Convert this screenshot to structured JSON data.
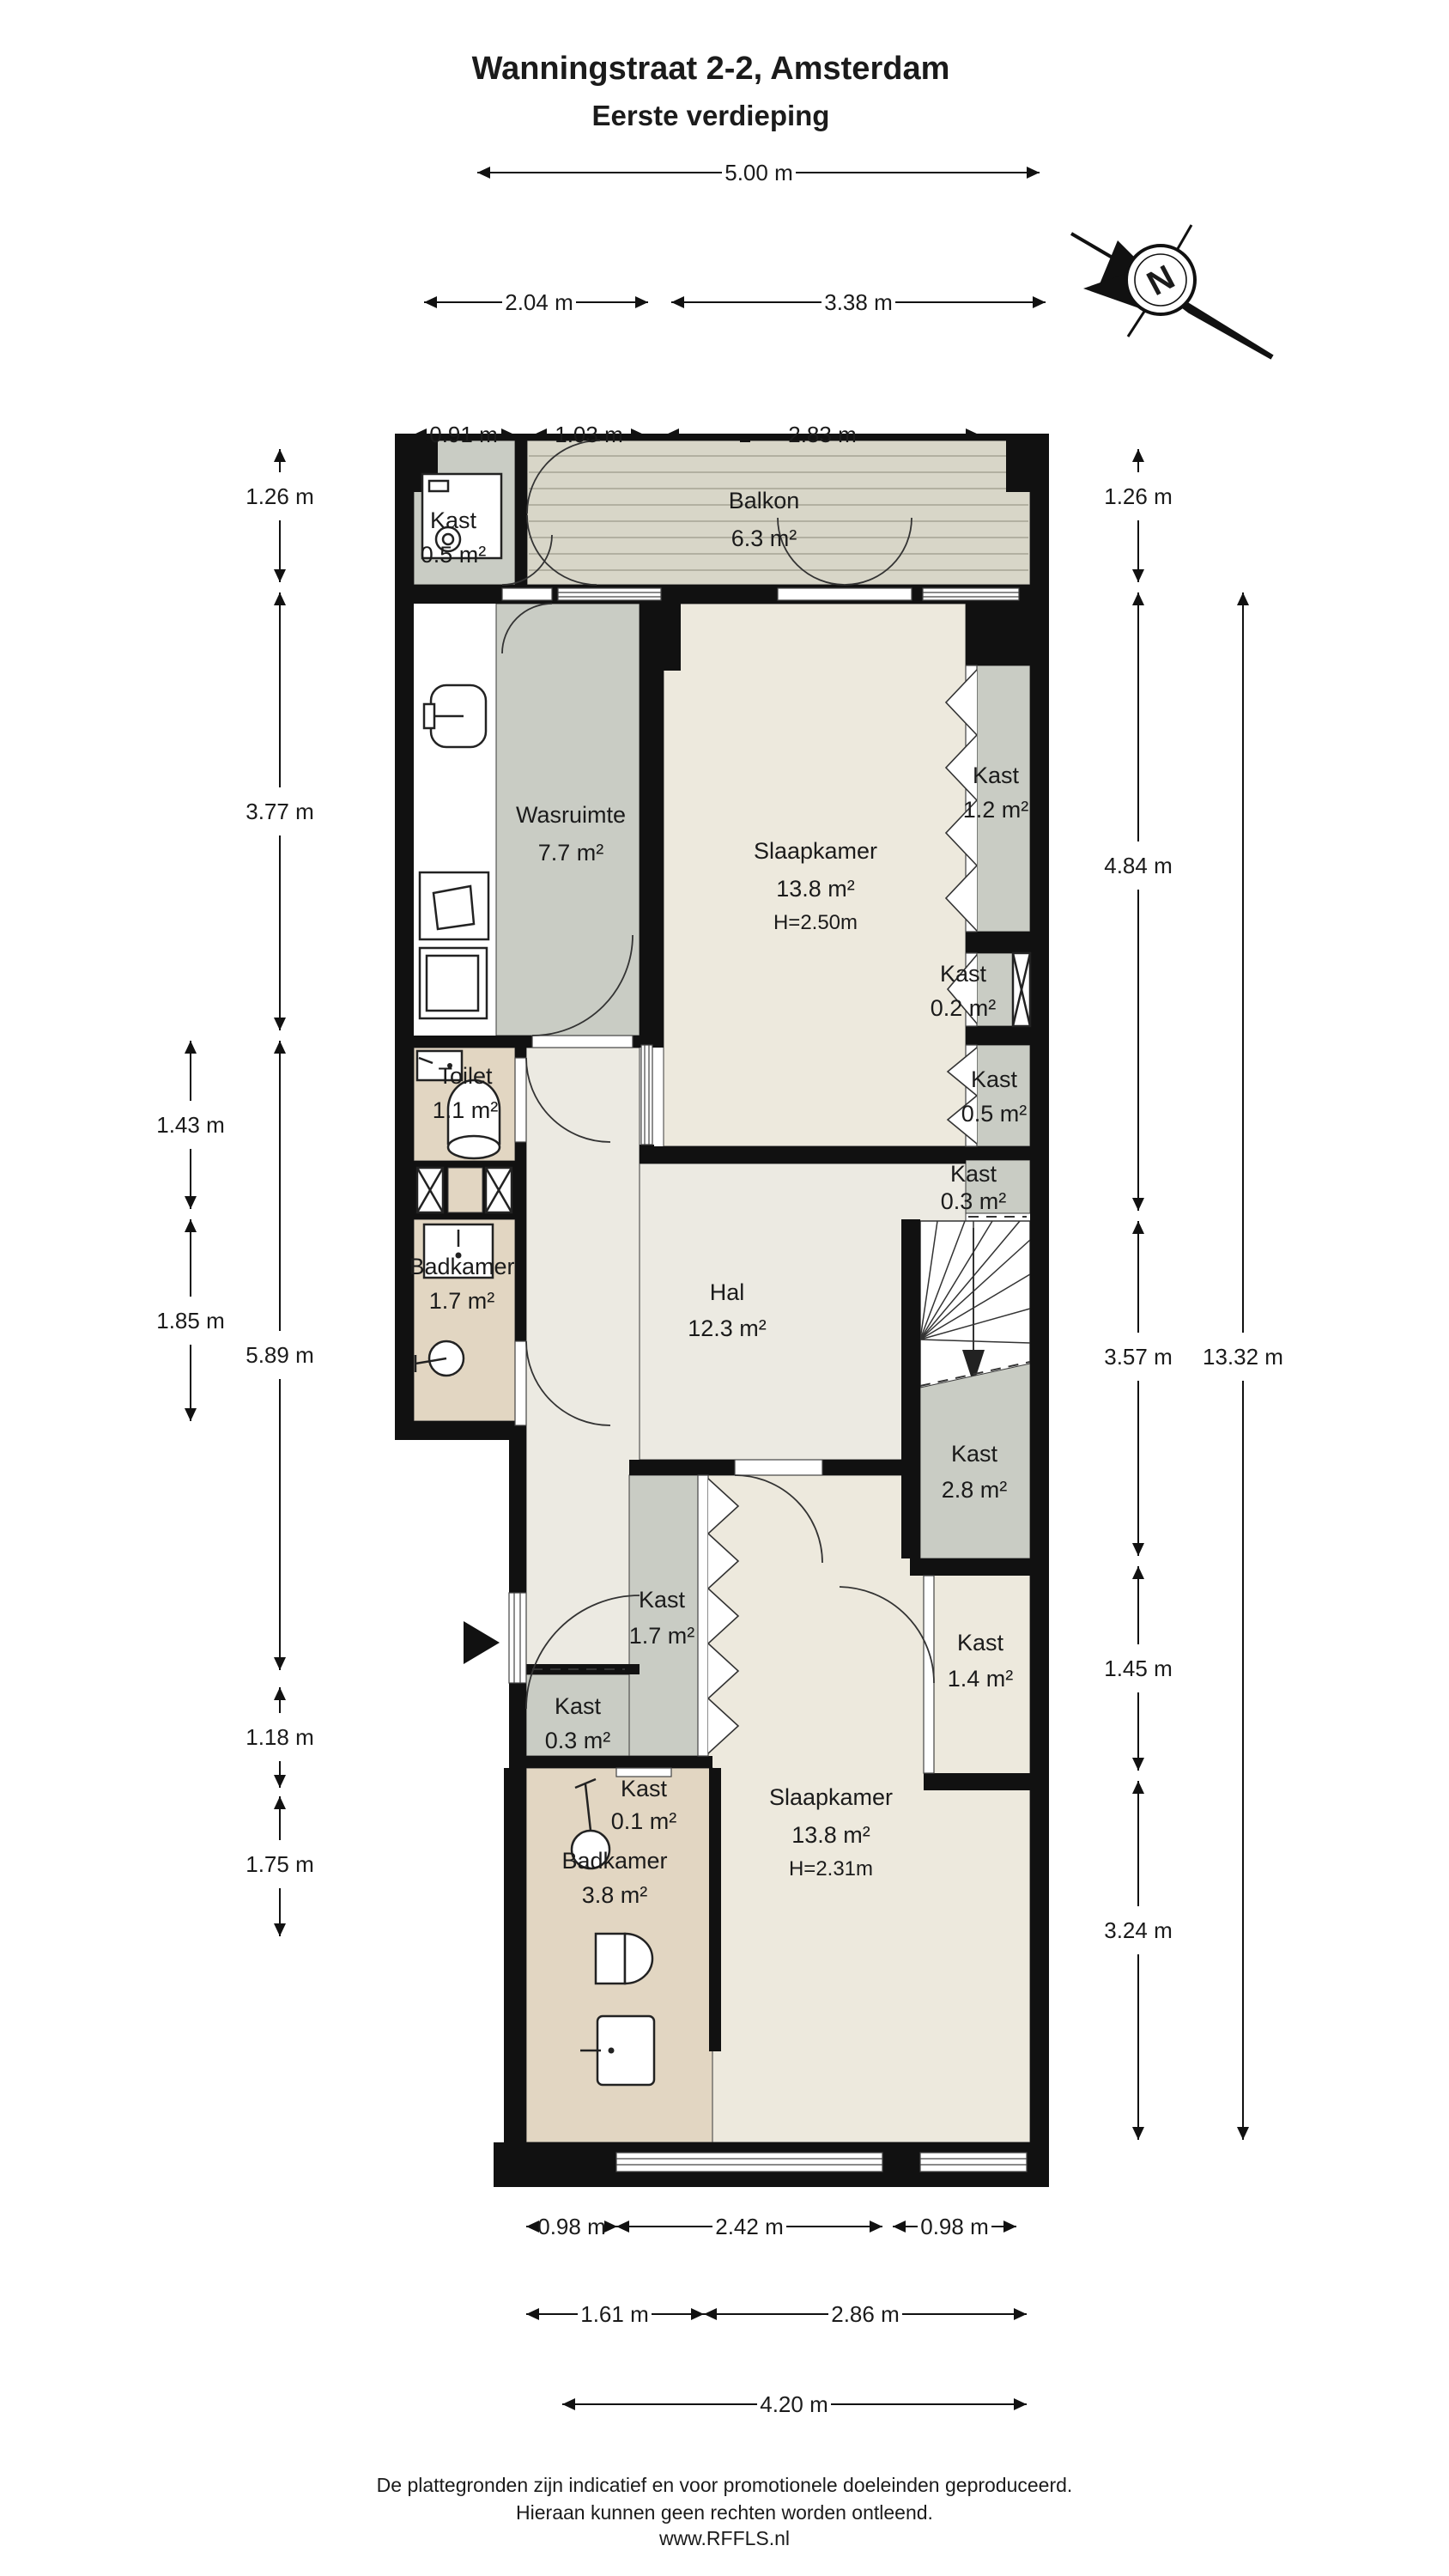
{
  "title": {
    "line1": "Wanningstraat 2-2, Amsterdam",
    "line2": "Eerste verdieping"
  },
  "compass": {
    "north_label": "N"
  },
  "rooms": {
    "kast_balkon": {
      "name": "Kast",
      "area": "0.5 m²"
    },
    "balkon": {
      "name": "Balkon",
      "area": "6.3 m²"
    },
    "wasruimte": {
      "name": "Wasruimte",
      "area": "7.7 m²"
    },
    "slaapkamer_boven": {
      "name": "Slaapkamer",
      "area": "13.8 m²",
      "hoogte": "H=2.50m"
    },
    "kast_1_2": {
      "name": "Kast",
      "area": "1.2 m²"
    },
    "kast_0_2": {
      "name": "Kast",
      "area": "0.2 m²"
    },
    "kast_0_5": {
      "name": "Kast",
      "area": "0.5 m²"
    },
    "kast_0_3_rechts": {
      "name": "Kast",
      "area": "0.3 m²"
    },
    "toilet": {
      "name": "Toilet",
      "area": "1.1 m²"
    },
    "badkamer_boven": {
      "name": "Badkamer",
      "area": "1.7 m²"
    },
    "hal": {
      "name": "Hal",
      "area": "12.3 m²"
    },
    "kast_2_8": {
      "name": "Kast",
      "area": "2.8 m²"
    },
    "kast_1_7": {
      "name": "Kast",
      "area": "1.7 m²"
    },
    "kast_1_4": {
      "name": "Kast",
      "area": "1.4 m²"
    },
    "kast_0_3_links": {
      "name": "Kast",
      "area": "0.3 m²"
    },
    "kast_0_1": {
      "name": "Kast",
      "area": "0.1 m²"
    },
    "badkamer_onder": {
      "name": "Badkamer",
      "area": "3.8 m²"
    },
    "slaapkamer_onder": {
      "name": "Slaapkamer",
      "area": "13.8 m²",
      "hoogte": "H=2.31m"
    }
  },
  "dimensions": {
    "top": [
      "5.00 m",
      "2.04 m",
      "3.38 m",
      "0.91 m",
      "1.03 m",
      "2.83 m"
    ],
    "left": [
      "1.26 m",
      "3.77 m",
      "1.43 m",
      "1.85 m",
      "5.89 m",
      "1.18 m",
      "1.75 m"
    ],
    "right": [
      "1.26 m",
      "4.84 m",
      "3.57 m",
      "1.45 m",
      "3.24 m",
      "13.32 m"
    ],
    "bottom": [
      "0.98 m",
      "2.42 m",
      "0.98 m",
      "1.61 m",
      "2.86 m",
      "4.20 m"
    ]
  },
  "footer": {
    "line1": "De plattegronden zijn indicatief en voor promotionele doeleinden geproduceerd.",
    "line2": "Hieraan kunnen geen rechten worden ontleend.",
    "line3": "www.RFFLS.nl"
  },
  "colors": {
    "wall": "#111111",
    "room_light": "#ede9dd",
    "hal_floor": "#eceae2",
    "kast_grey": "#c9ccc4",
    "sanitair_tan": "#e2d6c2",
    "balkon_deck": "#d8d6c8"
  }
}
